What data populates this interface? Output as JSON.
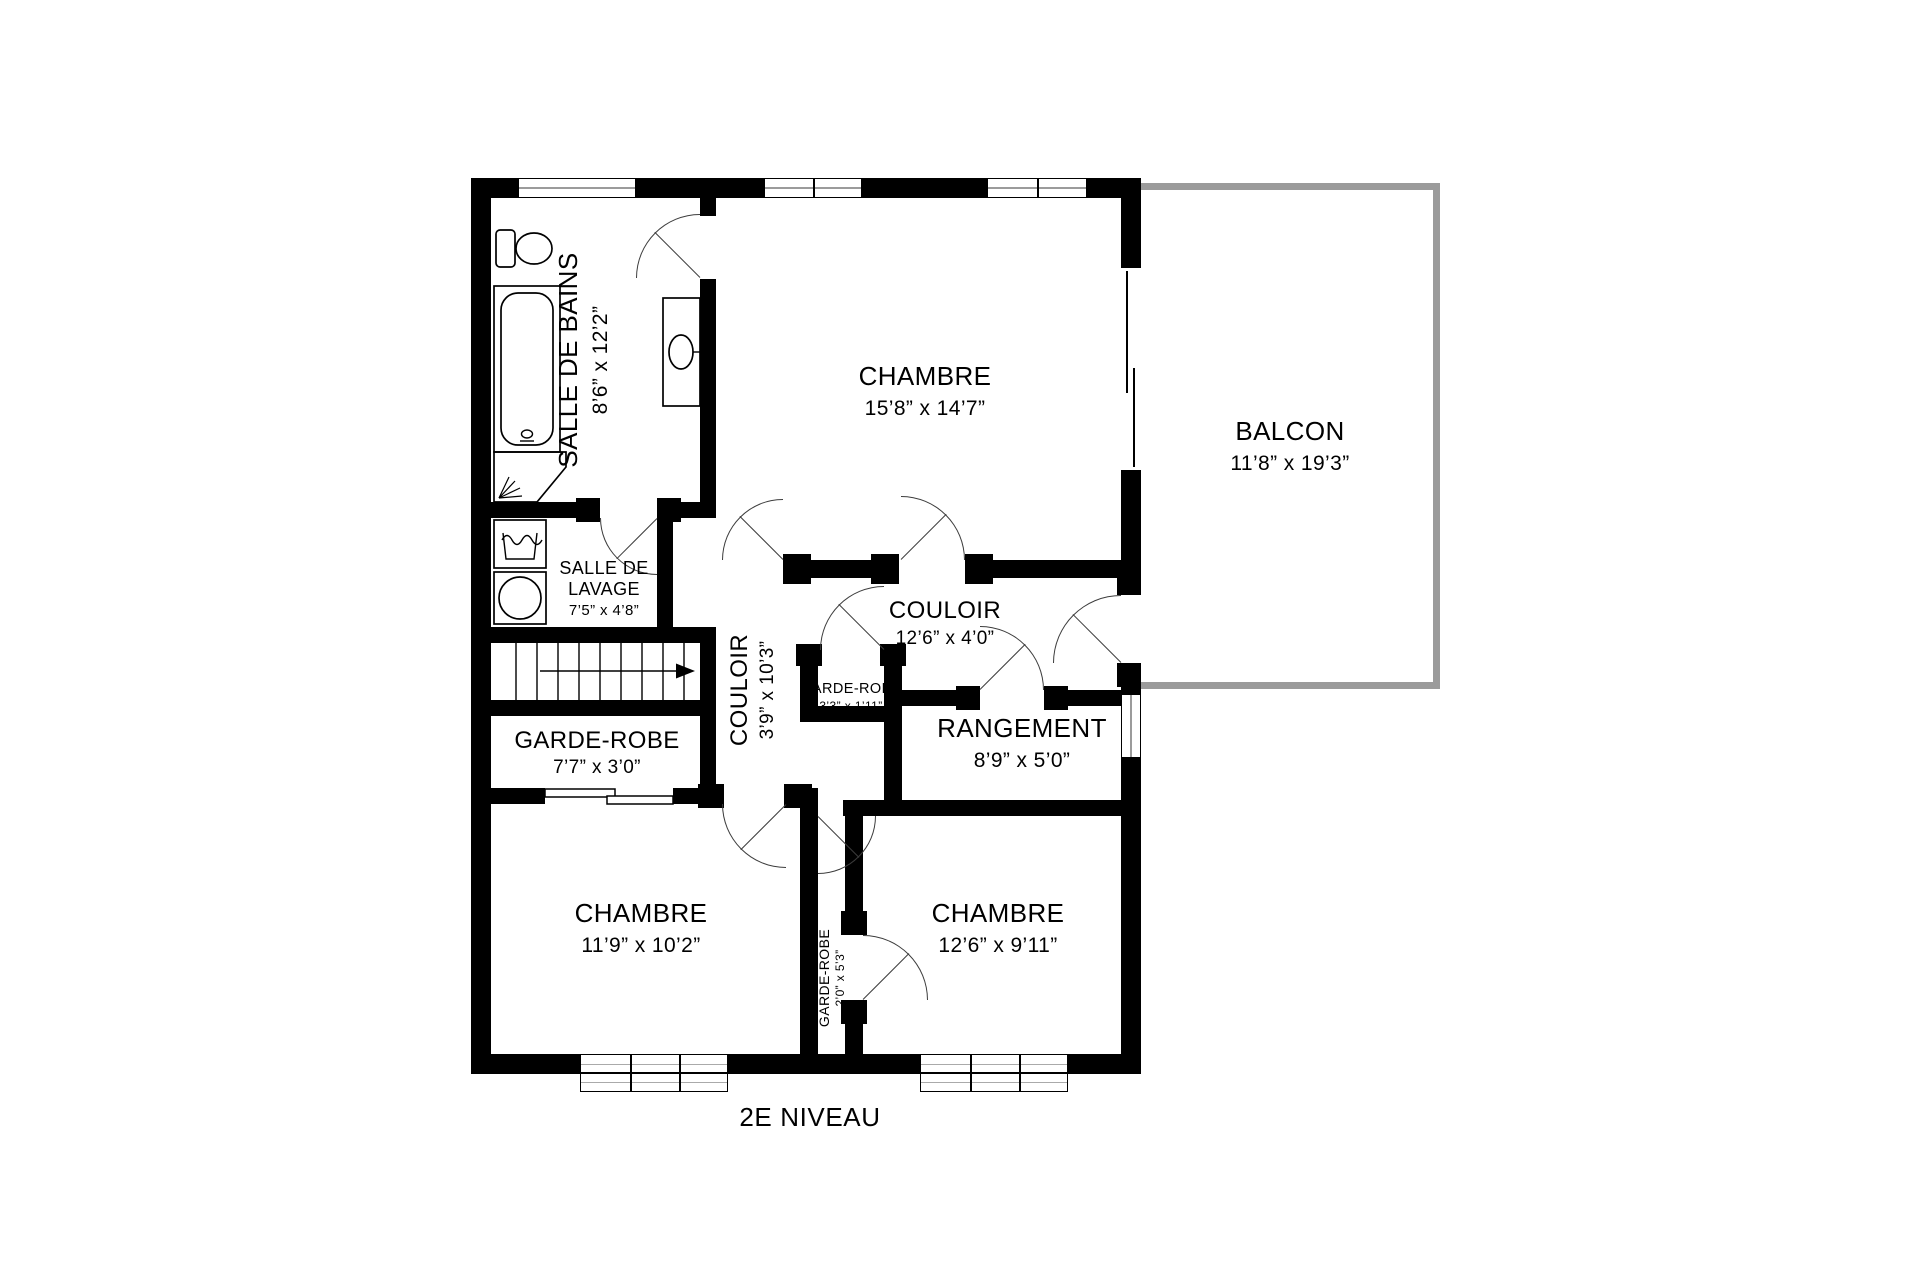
{
  "title": "2E NIVEAU",
  "rooms": {
    "salle_de_bains": {
      "label": "SALLE DE BAINS",
      "dims": "8’6” x 12’2”"
    },
    "chambre_principale": {
      "label": "CHAMBRE",
      "dims": "15’8” x 14’7”"
    },
    "balcon": {
      "label": "BALCON",
      "dims": "11’8” x 19’3”"
    },
    "salle_de_lavage": {
      "label_line1": "SALLE DE",
      "label_line2": "LAVAGE",
      "dims": "7’5” x 4’8”"
    },
    "couloir_vertical": {
      "label": "COULOIR",
      "dims": "3’9” x 10’3”"
    },
    "couloir_horizontal": {
      "label": "COULOIR",
      "dims": "12’6” x 4’0”"
    },
    "garde_robe_couloir": {
      "label": "GARDE-ROBE",
      "dims": "3’3” x 1’11”"
    },
    "rangement": {
      "label": "RANGEMENT",
      "dims": "8’9” x 5’0”"
    },
    "garde_robe_1": {
      "label": "GARDE-ROBE",
      "dims": "7’7” x 3’0”"
    },
    "chambre_2": {
      "label": "CHAMBRE",
      "dims": "11’9” x 10’2”"
    },
    "garde_robe_2": {
      "label": "GARDE-ROBE",
      "dims": "2’0” x 5’3”"
    },
    "chambre_3": {
      "label": "CHAMBRE",
      "dims": "12’6” x 9’11”"
    }
  },
  "colors": {
    "wall": "#000000",
    "balcony_wall": "#9b9b9b",
    "door_line": "#3c3c3c",
    "window_line": "#9b9b9b"
  }
}
